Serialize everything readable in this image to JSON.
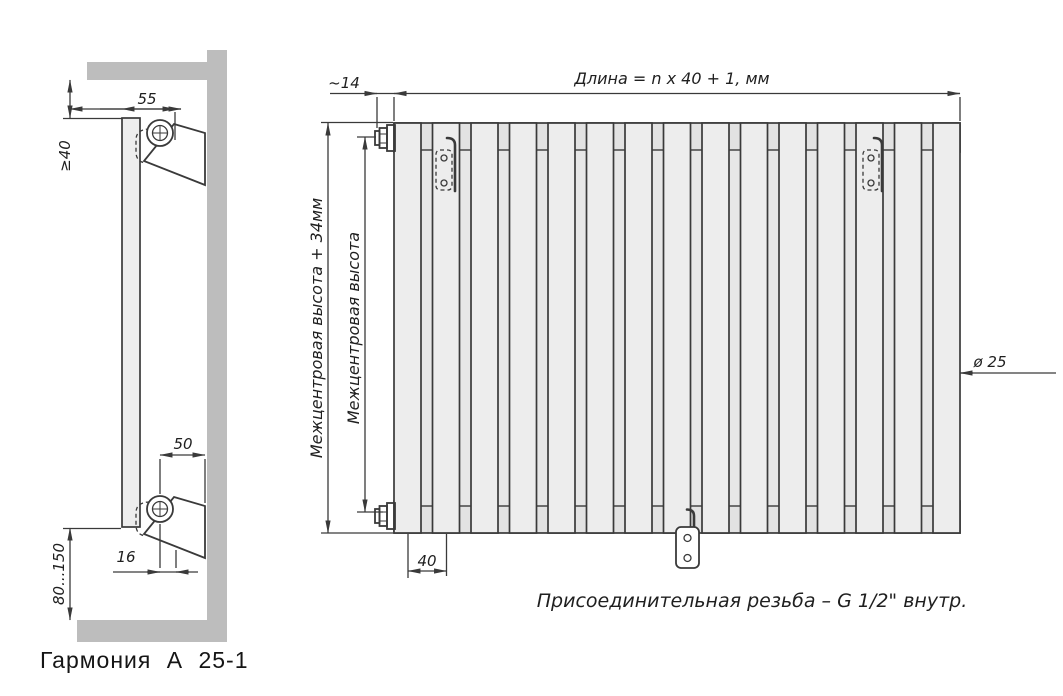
{
  "colors": {
    "line": "#3a3a3a",
    "wall_gray": "#bdbdbd",
    "tube_fill": "#ededed"
  },
  "side_view": {
    "caption": "Гармония  А 25-1",
    "dims": {
      "bracket_offset_top": "55",
      "ceiling_clearance": "≥40",
      "bracket_offset_bottom": "50",
      "pipe_to_wall": "16",
      "floor_clearance": "80...150"
    }
  },
  "front_view": {
    "tube_count": 15,
    "dims": {
      "valve_protrusion": "~14",
      "length_formula": "Длина = n x 40 + 1, мм",
      "height_overall": "Межцентровая высота + 34мм",
      "height_centers": "Межцентровая высота",
      "tube_diameter": "ø 25",
      "tube_pitch": "40"
    },
    "note": "Присоединительная резьба – G 1/2\" внутр."
  }
}
